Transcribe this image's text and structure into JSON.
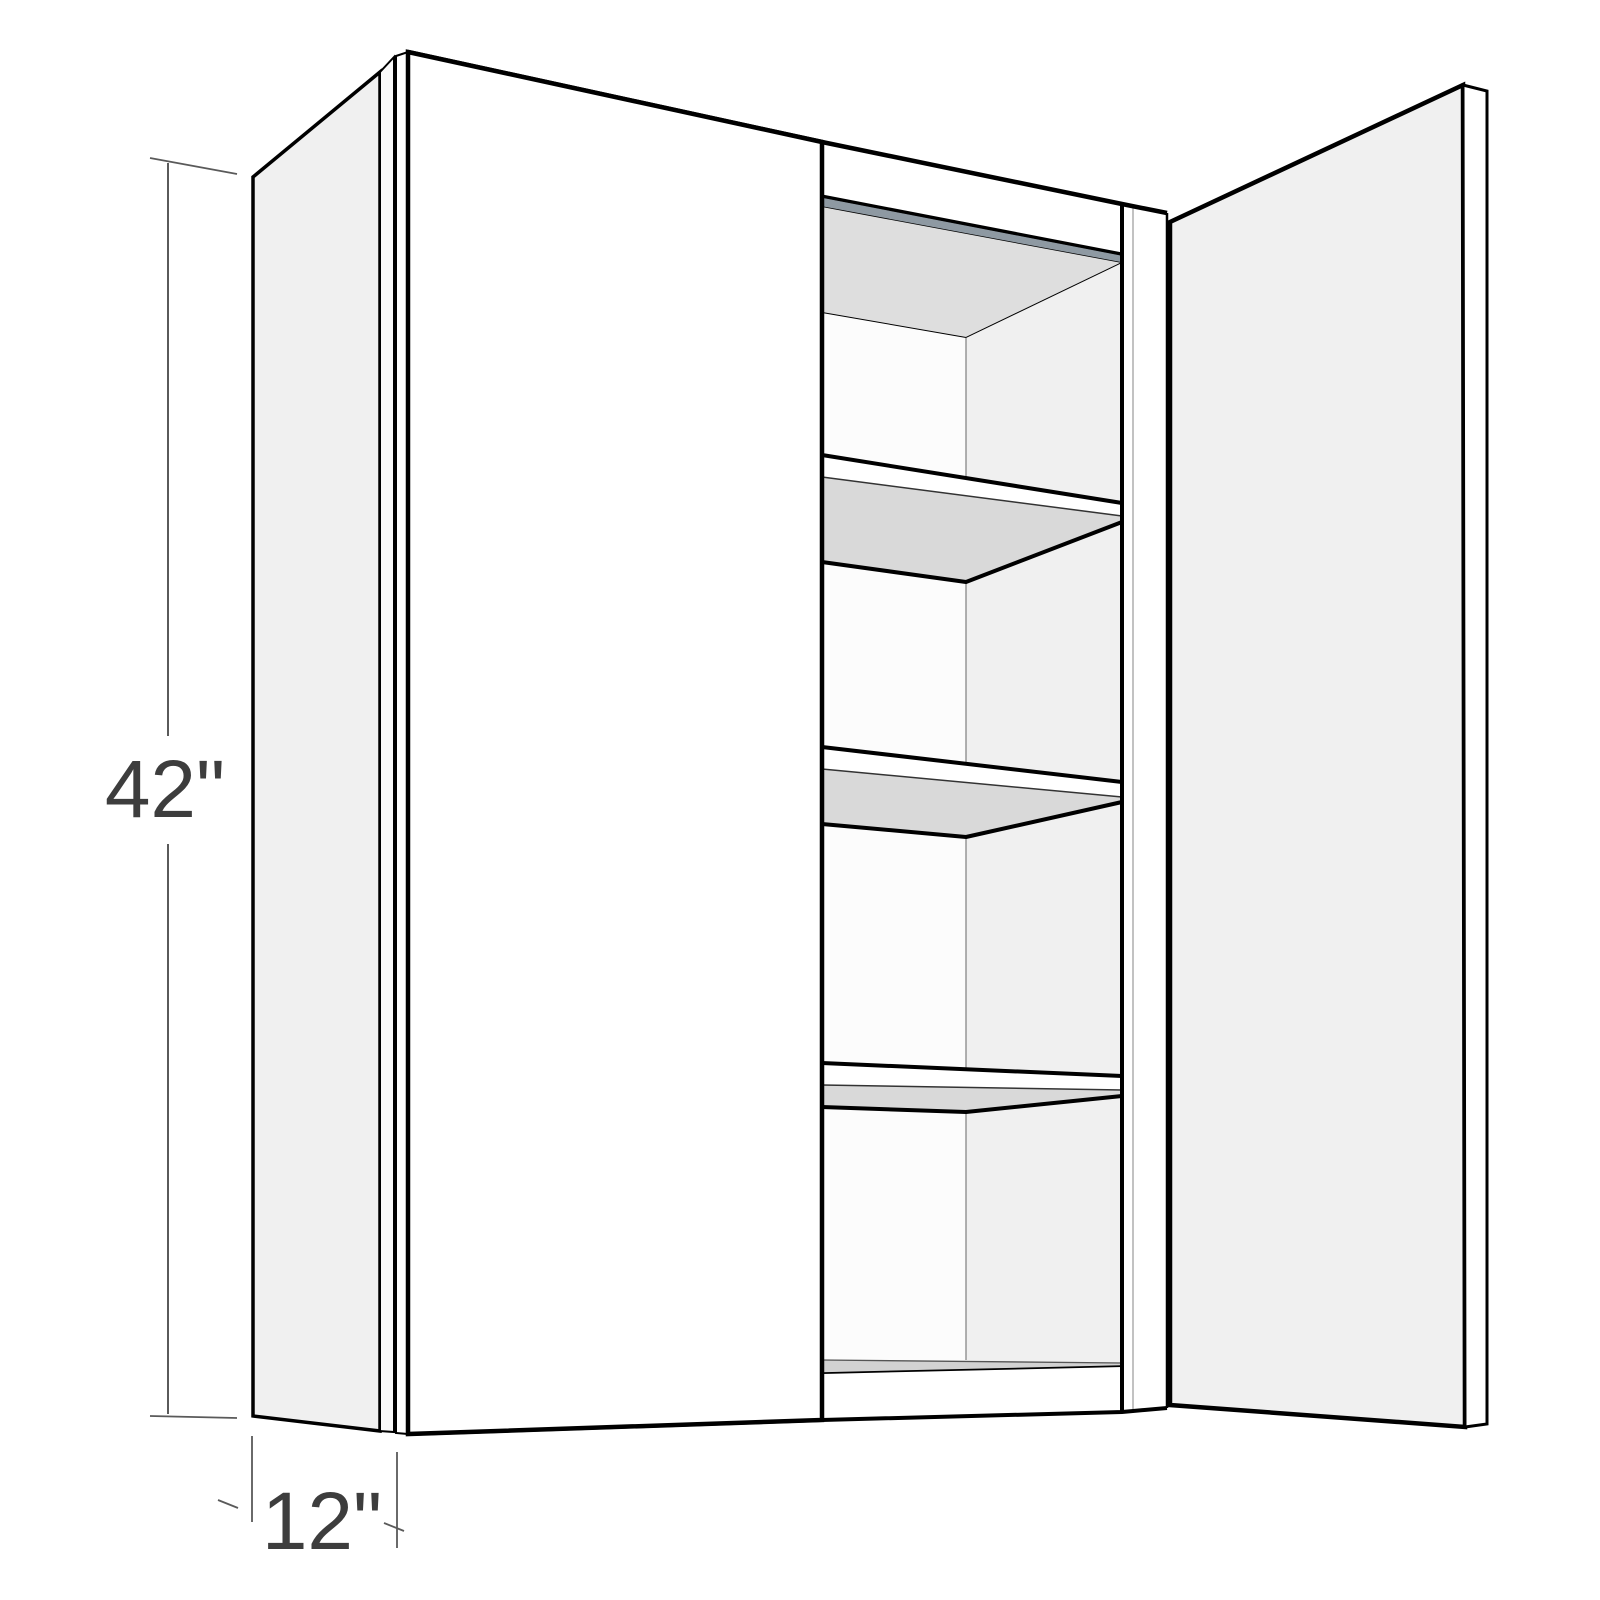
{
  "diagram": {
    "kind": "wall-cabinet-3d-line-drawing",
    "height_label": "42\"",
    "depth_label": "12\"",
    "visible_shelves": 3
  },
  "colors": {
    "background": "#ffffff",
    "outline": "#000000",
    "door-face": "#ffffff",
    "side-panel": "#f0f0f0",
    "open-door-face": "#f0f0f0",
    "interior-right-wall": "#f0f0f0",
    "interior-back-wall": "#fcfcfc",
    "ceiling": "#dedede",
    "shelf-underside": "#d9d9d9",
    "floor": "#d2d2d2",
    "hanging-rail": "#8e99a2",
    "dim-line": "#5a5a5a",
    "dim-text": "#3d3d3d"
  }
}
